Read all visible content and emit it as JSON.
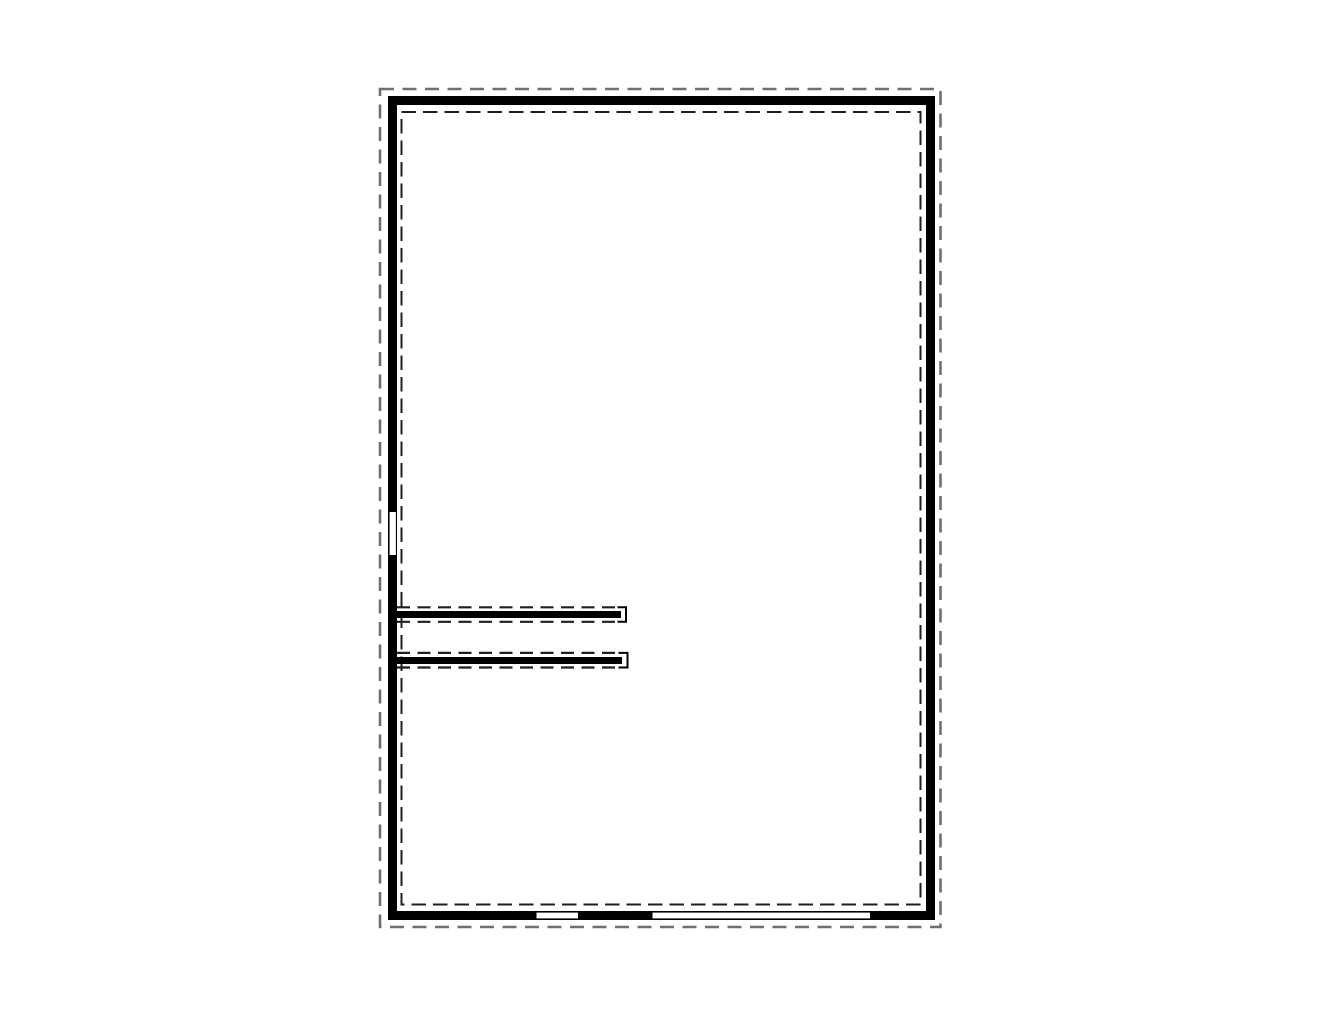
{
  "canvas": {
    "width_px": 1320,
    "height_px": 1020,
    "background": "#ffffff"
  },
  "colors": {
    "wall": "#000000",
    "window_fill": "#ffffff",
    "inner_dashed_line": "#1f1f1f",
    "outer_dashed_line": "#6f6f6f"
  },
  "plan": {
    "kind": "floor-plan-outline",
    "features": [
      "outer-dashed-boundary",
      "exterior-wall",
      "inner-dashed-boundary",
      "interior-wall-upper",
      "interior-wall-lower",
      "window-left-wall",
      "window-bottom-small",
      "window-bottom-large"
    ]
  }
}
